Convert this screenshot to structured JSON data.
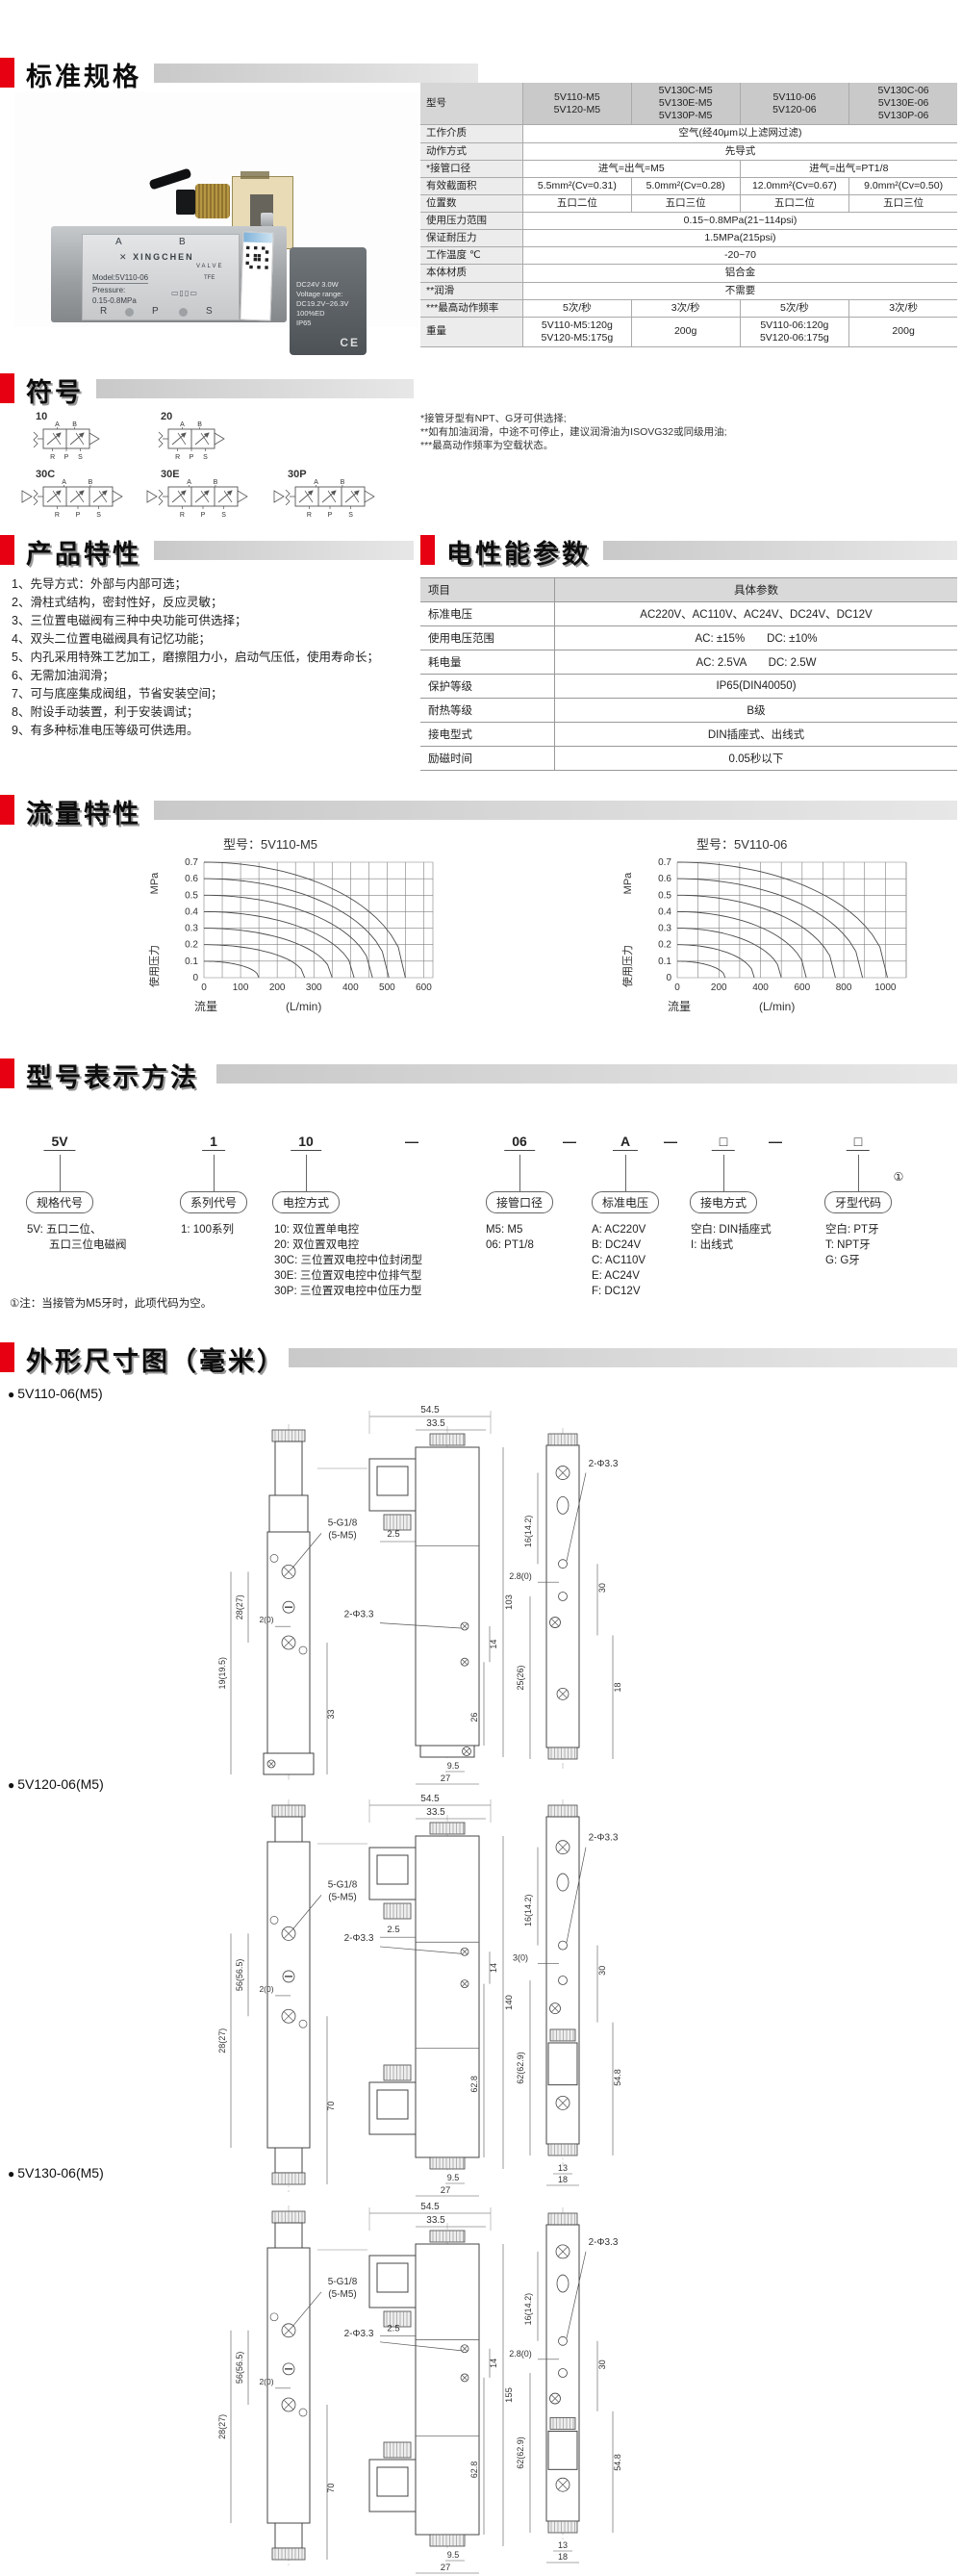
{
  "page": {
    "accent_red": "#e60012",
    "bar_gray": "#cccccc"
  },
  "sections": {
    "specs": {
      "title": "标准规格"
    },
    "symbols": {
      "title": "符号"
    },
    "features": {
      "title": "产品特性"
    },
    "electrical": {
      "title": "电性能参数"
    },
    "flow": {
      "title": "流量特性"
    },
    "model": {
      "title": "型号表示方法"
    },
    "dimensions": {
      "title": "外形尺寸图（毫米）"
    }
  },
  "photo": {
    "port_a": "A",
    "port_b": "B",
    "port_r": "R",
    "port_p": "P",
    "port_s": "S",
    "brand": "XINGCHEN",
    "brand_sub": "VALVE",
    "logo_mark": "✕",
    "model_line": "Model:5V110-06",
    "tfe": "TFE",
    "pressure_label": "Pressure:",
    "pressure_value": "0.15-0.8MPa",
    "coil_lines": [
      "DC24V   3.0W",
      "Voltage range:",
      "DC19.2V~26.3V",
      "100%ED",
      "IP65"
    ],
    "ce": "CE"
  },
  "spec_table": {
    "header_label": "型号",
    "models": [
      "5V110-M5\n5V120-M5",
      "5V130C-M5\n5V130E-M5\n5V130P-M5",
      "5V110-06\n5V120-06",
      "5V130C-06\n5V130E-06\n5V130P-06"
    ],
    "rows": [
      {
        "label": "工作介质",
        "cells": [
          {
            "text": "空气(经40μm以上滤网过滤)",
            "span": 4
          }
        ]
      },
      {
        "label": "动作方式",
        "cells": [
          {
            "text": "先导式",
            "span": 4
          }
        ]
      },
      {
        "label": "*接管口径",
        "cells": [
          {
            "text": "进气=出气=M5",
            "span": 2
          },
          {
            "text": "进气=出气=PT1/8",
            "span": 2
          }
        ]
      },
      {
        "label": "有效截面积",
        "cells": [
          {
            "text": "5.5mm²(Cv=0.31)"
          },
          {
            "text": "5.0mm²(Cv=0.28)"
          },
          {
            "text": "12.0mm²(Cv=0.67)"
          },
          {
            "text": "9.0mm²(Cv=0.50)"
          }
        ]
      },
      {
        "label": "位置数",
        "cells": [
          {
            "text": "五口二位"
          },
          {
            "text": "五口三位"
          },
          {
            "text": "五口二位"
          },
          {
            "text": "五口三位"
          }
        ]
      },
      {
        "label": "使用压力范围",
        "cells": [
          {
            "text": "0.15~0.8MPa(21~114psi)",
            "span": 4
          }
        ]
      },
      {
        "label": "保证耐压力",
        "cells": [
          {
            "text": "1.5MPa(215psi)",
            "span": 4
          }
        ]
      },
      {
        "label": "工作温度 ℃",
        "cells": [
          {
            "text": "-20~70",
            "span": 4
          }
        ]
      },
      {
        "label": "本体材质",
        "cells": [
          {
            "text": "铝合金",
            "span": 4
          }
        ]
      },
      {
        "label": "**润滑",
        "cells": [
          {
            "text": "不需要",
            "span": 4
          }
        ]
      },
      {
        "label": "***最高动作频率",
        "cells": [
          {
            "text": "5次/秒"
          },
          {
            "text": "3次/秒"
          },
          {
            "text": "5次/秒"
          },
          {
            "text": "3次/秒"
          }
        ]
      },
      {
        "label": "重量",
        "cells": [
          {
            "text": "5V110-M5:120g\n5V120-M5:175g"
          },
          {
            "text": "200g"
          },
          {
            "text": "5V110-06:120g\n5V120-06:175g"
          },
          {
            "text": "200g"
          }
        ]
      }
    ],
    "footnotes": "*接管牙型有NPT、G牙可供选择;\n**如有加油润滑，中途不可停止，建议润滑油为ISOVG32或同级用油;\n***最高动作频率为空载状态。"
  },
  "symbols": {
    "items": [
      {
        "code": "10",
        "cells": 2
      },
      {
        "code": "20",
        "cells": 2
      },
      {
        "code": "30C",
        "cells": 3
      },
      {
        "code": "30E",
        "cells": 3
      },
      {
        "code": "30P",
        "cells": 3
      }
    ],
    "ports_top": [
      "A",
      "B"
    ],
    "ports_bottom": [
      "R",
      "P",
      "S"
    ]
  },
  "features": {
    "items": [
      "1、先导方式：外部与内部可选；",
      "2、滑柱式结构，密封性好，反应灵敏；",
      "3、三位置电磁阀有三种中央功能可供选择；",
      "4、双头二位置电磁阀具有记忆功能；",
      "5、内孔采用特殊工艺加工，磨擦阻力小，启动气压低，使用寿命长；",
      "6、无需加油润滑；",
      "7、可与底座集成阀组，节省安装空间；",
      "8、附设手动装置，利于安装调试；",
      "9、有多种标准电压等级可供选用。"
    ]
  },
  "electrical": {
    "header": [
      "项目",
      "具体参数"
    ],
    "rows": [
      [
        "标准电压",
        "AC220V、AC110V、AC24V、DC24V、DC12V"
      ],
      [
        "使用电压范围",
        "AC: ±15%　　DC: ±10%"
      ],
      [
        "耗电量",
        "AC: 2.5VA　　DC: 2.5W"
      ],
      [
        "保护等级",
        "IP65(DIN40050)"
      ],
      [
        "耐热等级",
        "B级"
      ],
      [
        "接电型式",
        "DIN插座式、出线式"
      ],
      [
        "励磁时间",
        "0.05秒以下"
      ]
    ]
  },
  "chart_data": [
    {
      "type": "line",
      "title": "型号：5V110-M5",
      "xlabel": "流量",
      "xunit": "(L/min)",
      "ylabel": "使用压力",
      "yunit": "MPa",
      "xlim": [
        0,
        625
      ],
      "xticks": [
        0,
        100,
        200,
        300,
        400,
        500,
        600
      ],
      "xminor": 50,
      "ylim": [
        0,
        0.7
      ],
      "yticks": [
        0,
        0.1,
        0.2,
        0.3,
        0.4,
        0.5,
        0.6,
        0.7
      ],
      "grid": true,
      "legend": "none",
      "series": [
        {
          "name": "0.1MPa",
          "start_pressure": 0.1,
          "end_flow": 150
        },
        {
          "name": "0.2MPa",
          "start_pressure": 0.2,
          "end_flow": 275
        },
        {
          "name": "0.3MPa",
          "start_pressure": 0.3,
          "end_flow": 350
        },
        {
          "name": "0.4MPa",
          "start_pressure": 0.4,
          "end_flow": 410
        },
        {
          "name": "0.5MPa",
          "start_pressure": 0.5,
          "end_flow": 460
        },
        {
          "name": "0.6MPa",
          "start_pressure": 0.6,
          "end_flow": 505
        },
        {
          "name": "0.7MPa",
          "start_pressure": 0.7,
          "end_flow": 550
        }
      ]
    },
    {
      "type": "line",
      "title": "型号：5V110-06",
      "xlabel": "流量",
      "xunit": "(L/min)",
      "ylabel": "使用压力",
      "yunit": "MPa",
      "xlim": [
        0,
        1100
      ],
      "xticks": [
        0,
        200,
        400,
        600,
        800,
        1000
      ],
      "xminor": 100,
      "ylim": [
        0,
        0.7
      ],
      "yticks": [
        0,
        0.1,
        0.2,
        0.3,
        0.4,
        0.5,
        0.6,
        0.7
      ],
      "grid": true,
      "legend": "none",
      "series": [
        {
          "name": "0.1MPa",
          "start_pressure": 0.1,
          "end_flow": 230
        },
        {
          "name": "0.2MPa",
          "start_pressure": 0.2,
          "end_flow": 370
        },
        {
          "name": "0.3MPa",
          "start_pressure": 0.3,
          "end_flow": 500
        },
        {
          "name": "0.4MPa",
          "start_pressure": 0.4,
          "end_flow": 620
        },
        {
          "name": "0.5MPa",
          "start_pressure": 0.5,
          "end_flow": 760
        },
        {
          "name": "0.6MPa",
          "start_pressure": 0.6,
          "end_flow": 890
        },
        {
          "name": "0.7MPa",
          "start_pressure": 0.7,
          "end_flow": 1010
        }
      ]
    }
  ],
  "model": {
    "segments": [
      {
        "code": "5V",
        "label": "规格代号",
        "options": [
          "5V: 五口二位、",
          "　　五口三位电磁阀"
        ]
      },
      {
        "code": "1",
        "label": "系列代号",
        "options": [
          "1: 100系列"
        ]
      },
      {
        "code": "10",
        "label": "电控方式",
        "options": [
          "10: 双位置单电控",
          "20: 双位置双电控",
          "30C: 三位置双电控中位封闭型",
          "30E: 三位置双电控中位排气型",
          "30P: 三位置双电控中位压力型"
        ]
      },
      {
        "code": "06",
        "label": "接管口径",
        "options": [
          "M5: M5",
          "06: PT1/8"
        ]
      },
      {
        "code": "A",
        "label": "标准电压",
        "options": [
          "A: AC220V",
          "B: DC24V",
          "C: AC110V",
          "E: AC24V",
          "F: DC12V"
        ]
      },
      {
        "code": "□",
        "label": "接电方式",
        "options": [
          "空白: DIN插座式",
          "I: 出线式"
        ]
      },
      {
        "code": "□",
        "label": "牙型代码",
        "mark": "①",
        "options": [
          "空白: PT牙",
          "T: NPT牙",
          "G: G牙"
        ]
      }
    ],
    "separator": "—",
    "note": "①注：当接管为M5牙时，此项代码为空。"
  },
  "dim_drawings": [
    {
      "label": "5V110-06(M5)",
      "front": {
        "thread": "5-G1/8",
        "thread2": "(5-M5)",
        "v1": "19(19.5)",
        "v2": "28(27)",
        "v3": "2(0)",
        "v4": "33"
      },
      "side": {
        "w1": "54.5",
        "w2": "33.5",
        "w3": "2.5",
        "holes": "2-Φ3.3",
        "h1": "103",
        "h2": "14",
        "h3": "26",
        "b1": "9.5",
        "b2": "27"
      },
      "end": {
        "t1": "16(14.2)",
        "t2": "2.8(0)",
        "holes": "2-Φ3.3",
        "r1": "30",
        "l1": "25(26)",
        "r2": "18",
        "b1": "",
        "b2": ""
      }
    },
    {
      "label": "5V120-06(M5)",
      "front": {
        "thread": "5-G1/8",
        "thread2": "(5-M5)",
        "v1": "28(27)",
        "v2": "56(56.5)",
        "v3": "2(0)",
        "v4": "70"
      },
      "side": {
        "w1": "54.5",
        "w2": "33.5",
        "w3": "2.5",
        "holes": "2-Φ3.3",
        "h1": "140",
        "h2": "14",
        "h3": "62.8",
        "b1": "9.5",
        "b2": "27"
      },
      "end": {
        "t1": "16(14.2)",
        "t2": "3(0)",
        "holes": "2-Φ3.3",
        "r1": "30",
        "l1": "62(62.9)",
        "r2": "54.8",
        "b1": "13",
        "b2": "18"
      }
    },
    {
      "label": "5V130-06(M5)",
      "front": {
        "thread": "5-G1/8",
        "thread2": "(5-M5)",
        "v1": "28(27)",
        "v2": "56(56.5)",
        "v3": "2(0)",
        "v4": "70"
      },
      "side": {
        "w1": "54.5",
        "w2": "33.5",
        "w3": "2.5",
        "holes": "2-Φ3.3",
        "h1": "155",
        "h2": "14",
        "h3": "62.8",
        "b1": "9.5",
        "b2": "27"
      },
      "end": {
        "t1": "16(14.2)",
        "t2": "2.8(0)",
        "holes": "2-Φ3.3",
        "r1": "30",
        "l1": "62(62.9)",
        "r2": "54.8",
        "b1": "13",
        "b2": "18"
      }
    }
  ]
}
